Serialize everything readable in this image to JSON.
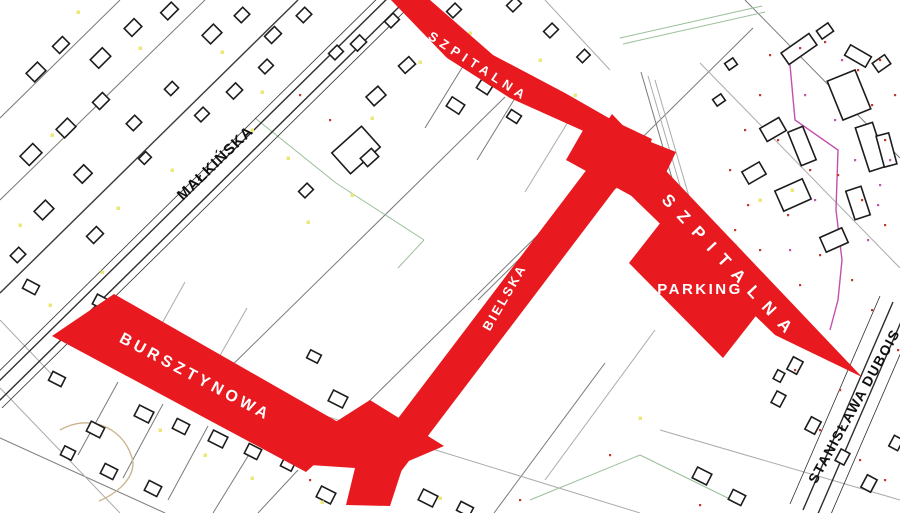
{
  "map": {
    "type": "cadastral-plan",
    "highlighted_roads": [
      {
        "id": "szpitalna-upper",
        "label": "SZPITALNA"
      },
      {
        "id": "szpitalna-lower",
        "label": "SZPITALNA"
      },
      {
        "id": "bielska",
        "label": "BIELSKA"
      },
      {
        "id": "bursztynowa",
        "label": "BURSZTYNOWA"
      }
    ],
    "background_roads": [
      {
        "id": "malkinska",
        "label": "MAŁKIŃSKA"
      },
      {
        "id": "dubois",
        "label": "STANISŁAWA DUBOIS"
      }
    ],
    "areas": [
      {
        "id": "parking",
        "label": "PARKING"
      }
    ]
  },
  "colors": {
    "background": "#ffffff",
    "highlight_red": "#e8191f",
    "road_label_on_red": "#ffffff",
    "road_label_on_map": "#101010",
    "building_outline": "#1c1c1c",
    "parcel_line": "#7a7a7a",
    "parcel_line_dark": "#3a3a3a",
    "parcel_line_light": "#ababab",
    "parcel_line_green": "#9bbf9b",
    "road_line": "#2e2e2e",
    "contour_tan": "#c9b48e",
    "utility_magenta": "#c44fae",
    "dot_yellow": "#ece878",
    "dot_red": "#c0392b",
    "dot_magenta": "#c653ae"
  }
}
